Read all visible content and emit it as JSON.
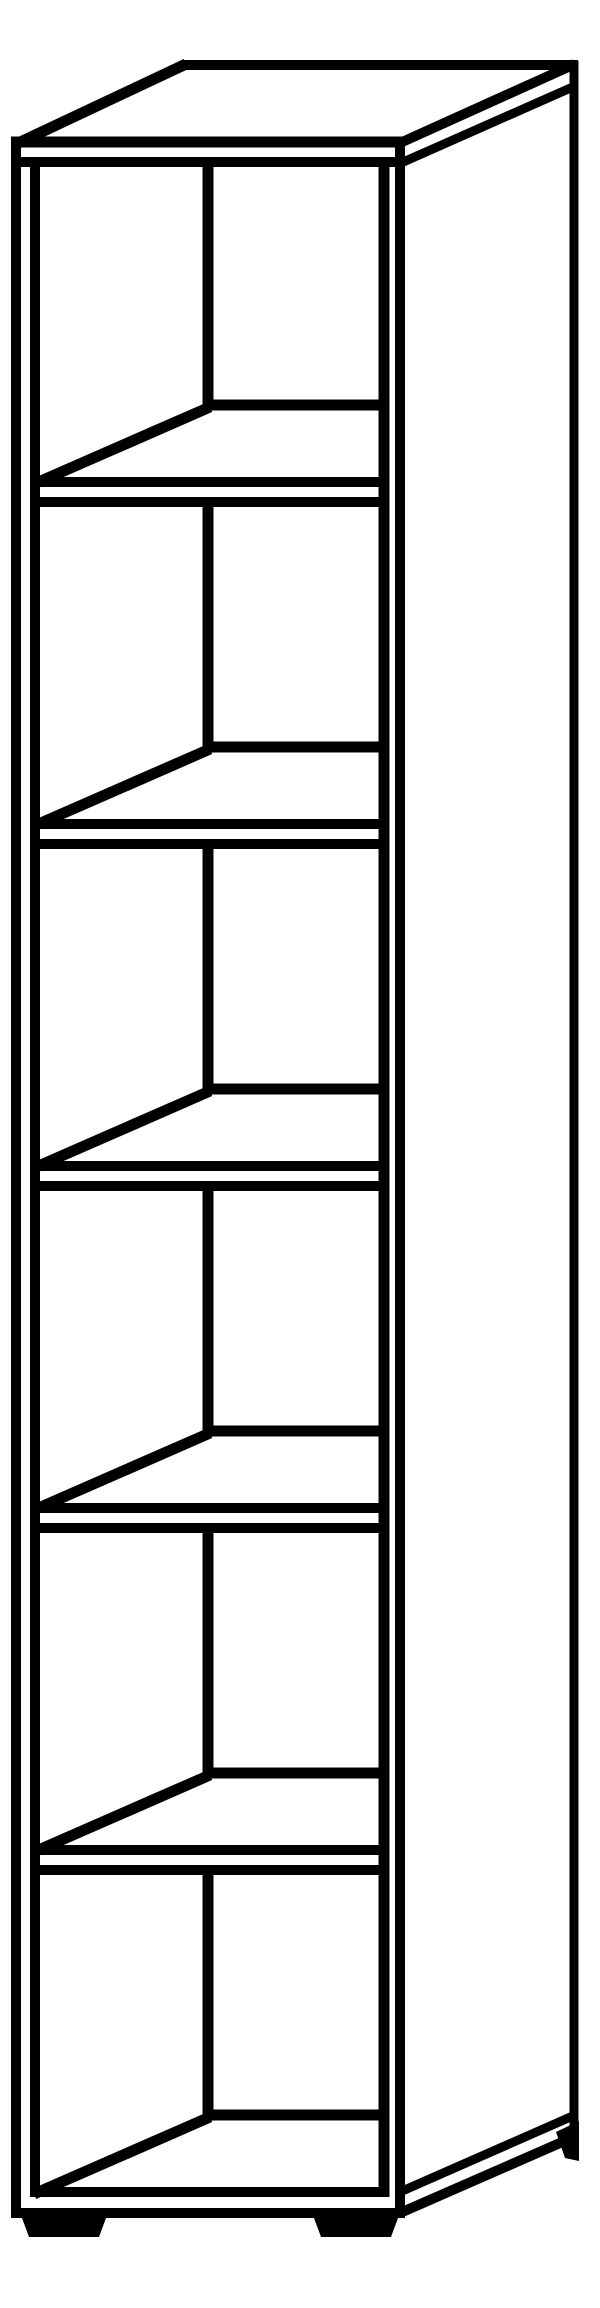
{
  "illustration": {
    "subject": "tall-narrow-shelf-unit-line-drawing",
    "description": "Black outline perspective drawing of a tall narrow bookcase with 6 open compartments, 5 shelves, top slab, side panel and 3 visible feet",
    "compartment_count": 6,
    "shelf_count": 5,
    "visible_feet_count": 3,
    "background_color": "#ffffff",
    "line_color": "#000000"
  },
  "canvas": {
    "width": 600,
    "height": 2308
  },
  "lines": [
    {
      "name": "front-left-outer-edge",
      "x1": 16,
      "y1": 137,
      "x2": 16,
      "y2": 2218,
      "w": 10
    },
    {
      "name": "front-left-inner-edge",
      "x1": 35,
      "y1": 157,
      "x2": 35,
      "y2": 2197,
      "w": 10
    },
    {
      "name": "front-right-inner-edge",
      "x1": 384,
      "y1": 157,
      "x2": 384,
      "y2": 2197,
      "w": 11
    },
    {
      "name": "front-right-corner-edge",
      "x1": 400,
      "y1": 137,
      "x2": 400,
      "y2": 2218,
      "w": 10
    },
    {
      "name": "back-right-corner-edge",
      "x1": 574,
      "y1": 61,
      "x2": 574,
      "y2": 2140,
      "w": 9
    },
    {
      "name": "interior-back-corner-seg-1",
      "x1": 208,
      "y1": 157,
      "x2": 208,
      "y2": 410,
      "w": 11
    },
    {
      "name": "interior-back-corner-seg-2",
      "x1": 208,
      "y1": 497,
      "x2": 208,
      "y2": 752,
      "w": 11
    },
    {
      "name": "interior-back-corner-seg-3",
      "x1": 208,
      "y1": 839,
      "x2": 208,
      "y2": 1094,
      "w": 11
    },
    {
      "name": "interior-back-corner-seg-4",
      "x1": 208,
      "y1": 1181,
      "x2": 208,
      "y2": 1436,
      "w": 11
    },
    {
      "name": "interior-back-corner-seg-5",
      "x1": 208,
      "y1": 1523,
      "x2": 208,
      "y2": 1778,
      "w": 11
    },
    {
      "name": "interior-back-corner-seg-6",
      "x1": 208,
      "y1": 1865,
      "x2": 208,
      "y2": 2120,
      "w": 11
    },
    {
      "name": "top-front-edge",
      "x1": 11,
      "y1": 142,
      "x2": 405,
      "y2": 142,
      "w": 11
    },
    {
      "name": "top-slab-bottom-edge",
      "x1": 11,
      "y1": 162,
      "x2": 405,
      "y2": 162,
      "w": 10
    },
    {
      "name": "top-back-edge",
      "x1": 184,
      "y1": 65,
      "x2": 578,
      "y2": 65,
      "w": 10
    },
    {
      "name": "top-left-receding-edge",
      "x1": 14,
      "y1": 145,
      "x2": 186,
      "y2": 64,
      "w": 11
    },
    {
      "name": "top-right-receding-edge",
      "x1": 400,
      "y1": 143,
      "x2": 575,
      "y2": 64,
      "w": 10
    },
    {
      "name": "top-slab-side-bottom-edge",
      "x1": 401,
      "y1": 163,
      "x2": 575,
      "y2": 86,
      "w": 9
    },
    {
      "name": "shelf-1-back-edge",
      "x1": 203,
      "y1": 405,
      "x2": 389,
      "y2": 405,
      "w": 11
    },
    {
      "name": "shelf-1-left-receding-edge",
      "x1": 34,
      "y1": 484,
      "x2": 210,
      "y2": 407,
      "w": 11
    },
    {
      "name": "shelf-1-front-top-edge",
      "x1": 30,
      "y1": 482,
      "x2": 389,
      "y2": 482,
      "w": 10
    },
    {
      "name": "shelf-1-front-bottom-edge",
      "x1": 30,
      "y1": 502,
      "x2": 389,
      "y2": 502,
      "w": 10
    },
    {
      "name": "shelf-2-back-edge",
      "x1": 203,
      "y1": 747,
      "x2": 389,
      "y2": 747,
      "w": 11
    },
    {
      "name": "shelf-2-left-receding-edge",
      "x1": 34,
      "y1": 826,
      "x2": 210,
      "y2": 749,
      "w": 11
    },
    {
      "name": "shelf-2-front-top-edge",
      "x1": 30,
      "y1": 824,
      "x2": 389,
      "y2": 824,
      "w": 10
    },
    {
      "name": "shelf-2-front-bottom-edge",
      "x1": 30,
      "y1": 844,
      "x2": 389,
      "y2": 844,
      "w": 10
    },
    {
      "name": "shelf-3-back-edge",
      "x1": 203,
      "y1": 1089,
      "x2": 389,
      "y2": 1089,
      "w": 11
    },
    {
      "name": "shelf-3-left-receding-edge",
      "x1": 34,
      "y1": 1168,
      "x2": 210,
      "y2": 1091,
      "w": 11
    },
    {
      "name": "shelf-3-front-top-edge",
      "x1": 30,
      "y1": 1166,
      "x2": 389,
      "y2": 1166,
      "w": 10
    },
    {
      "name": "shelf-3-front-bottom-edge",
      "x1": 30,
      "y1": 1186,
      "x2": 389,
      "y2": 1186,
      "w": 10
    },
    {
      "name": "shelf-4-back-edge",
      "x1": 203,
      "y1": 1431,
      "x2": 389,
      "y2": 1431,
      "w": 11
    },
    {
      "name": "shelf-4-left-receding-edge",
      "x1": 34,
      "y1": 1510,
      "x2": 210,
      "y2": 1433,
      "w": 11
    },
    {
      "name": "shelf-4-front-top-edge",
      "x1": 30,
      "y1": 1508,
      "x2": 389,
      "y2": 1508,
      "w": 10
    },
    {
      "name": "shelf-4-front-bottom-edge",
      "x1": 30,
      "y1": 1528,
      "x2": 389,
      "y2": 1528,
      "w": 10
    },
    {
      "name": "shelf-5-back-edge",
      "x1": 203,
      "y1": 1773,
      "x2": 389,
      "y2": 1773,
      "w": 11
    },
    {
      "name": "shelf-5-left-receding-edge",
      "x1": 34,
      "y1": 1852,
      "x2": 210,
      "y2": 1775,
      "w": 11
    },
    {
      "name": "shelf-5-front-top-edge",
      "x1": 30,
      "y1": 1850,
      "x2": 389,
      "y2": 1850,
      "w": 10
    },
    {
      "name": "shelf-5-front-bottom-edge",
      "x1": 30,
      "y1": 1870,
      "x2": 389,
      "y2": 1870,
      "w": 10
    },
    {
      "name": "bottom-back-edge",
      "x1": 203,
      "y1": 2115,
      "x2": 389,
      "y2": 2115,
      "w": 11
    },
    {
      "name": "bottom-left-receding-edge",
      "x1": 34,
      "y1": 2194,
      "x2": 210,
      "y2": 2117,
      "w": 11
    },
    {
      "name": "bottom-front-top-edge",
      "x1": 30,
      "y1": 2192,
      "x2": 389,
      "y2": 2192,
      "w": 10
    },
    {
      "name": "bottom-front-bottom-edge",
      "x1": 11,
      "y1": 2213,
      "x2": 405,
      "y2": 2213,
      "w": 10
    },
    {
      "name": "side-bottom-upper-edge",
      "x1": 400,
      "y1": 2192,
      "x2": 575,
      "y2": 2115,
      "w": 9
    },
    {
      "name": "side-bottom-lower-edge",
      "x1": 400,
      "y1": 2213,
      "x2": 576,
      "y2": 2136,
      "w": 10
    }
  ],
  "polygons": [
    {
      "name": "front-left-foot",
      "points": [
        [
          22,
          2218
        ],
        [
          106,
          2218
        ],
        [
          99,
          2237
        ],
        [
          29,
          2237
        ]
      ]
    },
    {
      "name": "front-right-foot",
      "points": [
        [
          314,
          2218
        ],
        [
          398,
          2218
        ],
        [
          391,
          2237
        ],
        [
          321,
          2237
        ]
      ]
    },
    {
      "name": "back-right-foot",
      "points": [
        [
          556,
          2132
        ],
        [
          579,
          2121
        ],
        [
          579,
          2161
        ],
        [
          565,
          2158
        ]
      ]
    }
  ]
}
